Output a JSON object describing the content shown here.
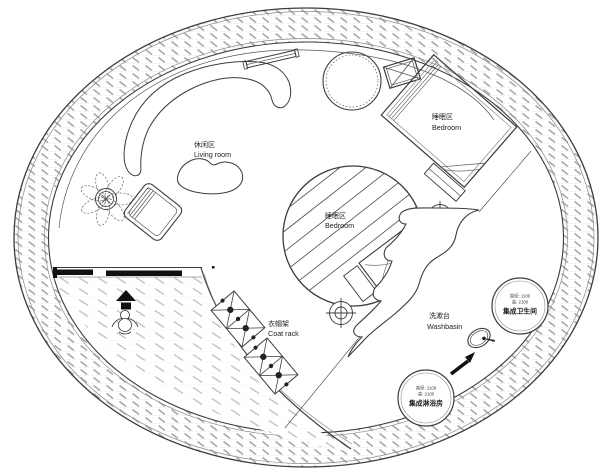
{
  "plan": {
    "labels": {
      "living_room": {
        "zh": "休闲区",
        "en": "Living room"
      },
      "bedroom_upper": {
        "zh": "睡眠区",
        "en": "Bedroom"
      },
      "bedroom_center": {
        "zh": "睡眠区",
        "en": "Bedroom"
      },
      "coat_rack": {
        "zh": "衣帽架",
        "en": "Coat rack"
      },
      "washbasin": {
        "zh": "洗漱台",
        "en": "Washbasin"
      },
      "toilet_pod": {
        "dim_diameter": "直径: 1100",
        "dim_height": "高: 2100",
        "name": "集成卫生间"
      },
      "shower_pod": {
        "dim_diameter": "直径: 1100",
        "dim_height": "高: 2100",
        "name": "集成淋浴房"
      }
    },
    "colors": {
      "line": "#3c3c3c",
      "hatch_wall": "#a9a9a9",
      "hatch_floor": "#c6c6c6",
      "background": "#ffffff",
      "text": "#222222"
    }
  }
}
